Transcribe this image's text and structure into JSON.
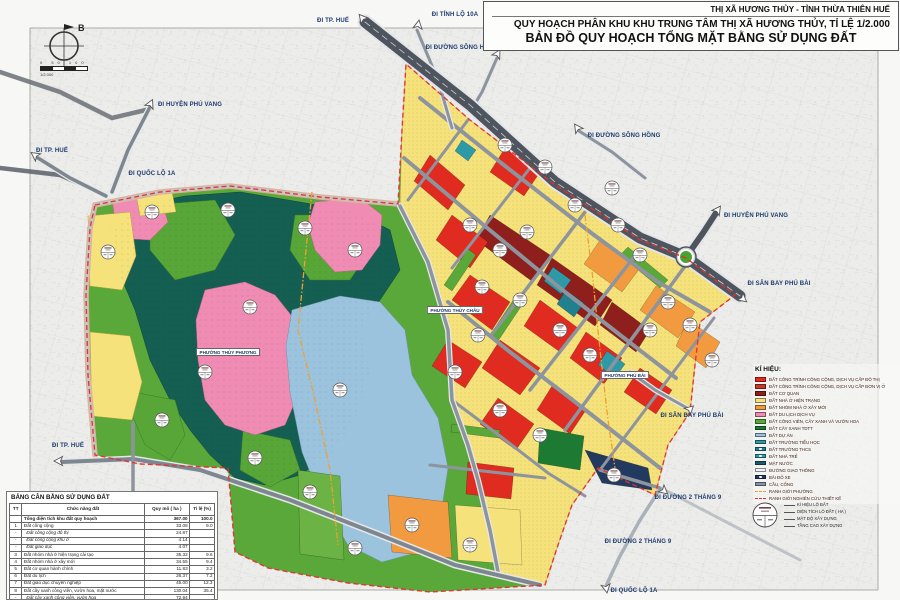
{
  "title_block": {
    "line1": "THỊ XÃ HƯƠNG THỦY - TỈNH THỪA THIÊN HUẾ",
    "line2": "QUY HOẠCH PHÂN KHU KHU TRUNG TÂM THỊ XÃ HƯƠNG THỦY, TỈ LỆ 1/2.000",
    "line3": "BẢN ĐỒ QUY HOẠCH TỔNG MẶT BẰNG SỬ DỤNG ĐẤT"
  },
  "compass": {
    "north_label": "B"
  },
  "scale": {
    "ticks": "0 50 100",
    "ratio": "1/2.000"
  },
  "map": {
    "road_labels": {
      "tp_hue": "ĐI TP. HUẾ",
      "tinh_lo_10a": "ĐI TỈNH LỘ 10A",
      "duong_song_hong": "ĐI ĐƯỜNG SÔNG HỒNG",
      "huyen_phu_vang": "ĐI HUYỆN PHÚ VANG",
      "san_bay_phu_bai": "ĐI SÂN BAY PHÚ BÀI",
      "quoc_lo_1a": "ĐI QUỐC LỘ 1A",
      "xa_phu_son": "ĐI XÃ PHÚ SƠN",
      "duong_2_thang_9": "ĐI ĐƯỜNG 2 THÁNG 9"
    },
    "ward_labels": {
      "thuy_phuong": "PHƯỜNG THỦY PHƯƠNG",
      "thuy_chau": "PHƯỜNG THỦY CHÂU",
      "phu_bai": "PHƯỜNG PHÚ BÀI"
    }
  },
  "legend": {
    "title": "KÍ HIỆU:",
    "items": [
      {
        "label": "ĐẤT CÔNG TRÌNH CÔNG CỘNG, DỊCH VỤ CẤP ĐÔ THỊ",
        "color": "#e02b20"
      },
      {
        "label": "ĐẤT CÔNG TRÌNH CÔNG CỘNG, DỊCH VỤ CẤP ĐƠN VỊ Ở",
        "color": "#c23a28"
      },
      {
        "label": "ĐẤT CƠ QUAN",
        "color": "#8e1f1c"
      },
      {
        "label": "ĐẤT NHÀ Ở HIỆN TRẠNG",
        "color": "#f5e27a"
      },
      {
        "label": "ĐẤT NHÓM NHÀ Ở XÂY MỚI",
        "color": "#f29a40"
      },
      {
        "label": "ĐẤT DU LỊCH DỊCH VỤ",
        "color": "#f08cb4"
      },
      {
        "label": "ĐẤT CÔNG VIÊN, CÂY XANH VÀ VƯỜN HOA",
        "color": "#5aa839"
      },
      {
        "label": "ĐẤT CÂY XANH TDTT",
        "color": "#1c7a33"
      },
      {
        "label": "ĐẤT DỰ ÁN",
        "color": "#9cc3de"
      },
      {
        "label": "ĐẤT TRƯỜNG TIỂU HỌC",
        "color": "#2e9aa8"
      },
      {
        "label": "ĐẤT TRƯỜNG THCS",
        "color": "#21808e"
      },
      {
        "label": "ĐẤT NHÀ TRẺ",
        "color": "#2e9aa8"
      },
      {
        "label": "MẶT NƯỚC",
        "color": "#185f6b"
      },
      {
        "label": "ĐƯỜNG GIAO THÔNG",
        "color": "#f2f3f4"
      },
      {
        "label": "BÃI ĐỖ XE",
        "color": "#233a60"
      },
      {
        "label": "CẦU, CỐNG",
        "color": "#8a93a0"
      },
      {
        "label": "RANH GIỚI PHƯỜNG",
        "color": "#f0a030"
      },
      {
        "label": "RANH GIỚI NGHIÊN CỨU THIẾT KẾ",
        "color": "#e03030"
      }
    ],
    "lot_symbol_labels": [
      "KÍ HIỆU LÔ ĐẤT",
      "DIỆN TÍCH LÔ ĐẤT ( HA )",
      "MẬT ĐỘ XÂY DỰNG",
      "TẦNG CAO XÂY DỰNG"
    ]
  },
  "table": {
    "title": "BẢNG CÂN BẰNG SỬ DỤNG ĐẤT",
    "columns": [
      "TT",
      "Chức năng đất",
      "Quy mô ( ha )",
      "Tỉ lệ (%)"
    ],
    "rows": [
      {
        "tt": "",
        "name": "Tổng diện tích khu đất quy hoạch",
        "area": "367.00",
        "pct": "100.0"
      },
      {
        "tt": "1",
        "name": "Đất công cộng",
        "area": "33.08",
        "pct": "9.0"
      },
      {
        "tt": "-",
        "name": "Đất công cộng đô thị",
        "area": "24.87",
        "pct": ""
      },
      {
        "tt": "-",
        "name": "Đất công cộng khu ở",
        "area": "4.14",
        "pct": ""
      },
      {
        "tt": "-",
        "name": "Đất giáo dục",
        "area": "4.07",
        "pct": ""
      },
      {
        "tt": "3",
        "name": "Đất nhóm nhà ở hiện trạng cải tạo",
        "area": "35.32",
        "pct": "9.6"
      },
      {
        "tt": "4",
        "name": "Đất nhóm nhà ở xây mới",
        "area": "34.55",
        "pct": "9.4"
      },
      {
        "tt": "5",
        "name": "Đất cơ quan hành chính",
        "area": "11.83",
        "pct": "3.2"
      },
      {
        "tt": "6",
        "name": "Đất du lịch",
        "area": "26.37",
        "pct": "7.2"
      },
      {
        "tt": "7",
        "name": "Đất giáo dục chuyên nghiệp",
        "area": "45.00",
        "pct": "12.3"
      },
      {
        "tt": "8",
        "name": "Đất cây xanh công viên, vườn hoa, mặt nước",
        "area": "130.04",
        "pct": "35.4"
      },
      {
        "tt": "-",
        "name": "Đất cây xanh công viên, vườn hoa",
        "area": "72.94",
        "pct": ""
      },
      {
        "tt": "-",
        "name": "Đất trung tâm TDTT",
        "area": "4.09",
        "pct": ""
      },
      {
        "tt": "-",
        "name": "Mặt nước",
        "area": "53.01",
        "pct": ""
      }
    ]
  }
}
